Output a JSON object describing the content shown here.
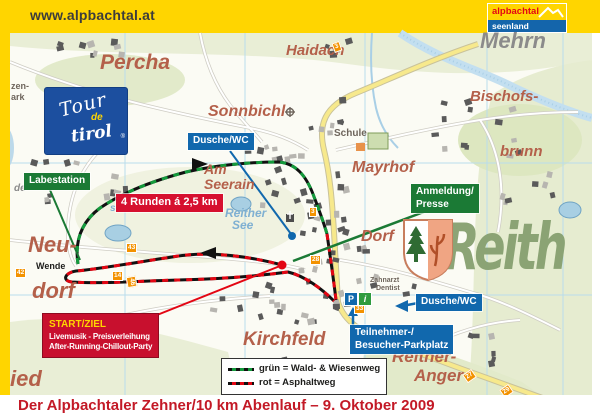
{
  "banner": {
    "url": "www.alpbachtal.at",
    "logo_line1": "alpbachtal",
    "logo_line2": "seenland"
  },
  "caption": "Der Alpbachtaler Zehner/10 km Abenlauf – 9. Oktober 2009",
  "tour_logo": {
    "line1": "Tour",
    "line2": "de",
    "line3": "tirol",
    "reg": "®"
  },
  "reith_watermark": "Reith",
  "info_boxes": {
    "labestation": "Labestation",
    "runden": "4 Runden á 2,5 km",
    "dusche1": "Dusche/WC",
    "dusche2": "Dusche/WC",
    "anmeldung_line1": "Anmeldung/",
    "anmeldung_line2": "Presse",
    "teilnehmer_line1": "Teilnehmer-/",
    "teilnehmer_line2": "Besucher-Parkplatz"
  },
  "start_box": {
    "title": "START/ZIEL",
    "line1": "Livemusik - Preisverleihung",
    "line2": "After-Running-Chillout-Party"
  },
  "legend": {
    "line1": "grün = Wald- & Wiesenweg",
    "line2": "rot = Asphaltweg"
  },
  "icons": {
    "parking": "P",
    "info": "i"
  },
  "places": [
    {
      "t": "Percha",
      "x": 100,
      "y": 52,
      "fs": 21
    },
    {
      "t": "Haidach",
      "x": 286,
      "y": 43,
      "fs": 15
    },
    {
      "t": "Mehrn",
      "x": 480,
      "y": 30,
      "fs": 22,
      "c": "grey"
    },
    {
      "t": "Bischofs-",
      "x": 470,
      "y": 89,
      "fs": 15
    },
    {
      "t": "brunn",
      "x": 500,
      "y": 144,
      "fs": 15
    },
    {
      "t": "Sonnbichl",
      "x": 208,
      "y": 104,
      "fs": 16
    },
    {
      "t": "Am",
      "x": 204,
      "y": 162,
      "fs": 14
    },
    {
      "t": "Seerain",
      "x": 204,
      "y": 177,
      "fs": 14
    },
    {
      "t": "Mayrhof",
      "x": 352,
      "y": 160,
      "fs": 16
    },
    {
      "t": "Dorf",
      "x": 361,
      "y": 229,
      "fs": 16
    },
    {
      "t": "Neu-",
      "x": 28,
      "y": 234,
      "fs": 22
    },
    {
      "t": "dorf",
      "x": 32,
      "y": 280,
      "fs": 22
    },
    {
      "t": "ied",
      "x": 10,
      "y": 368,
      "fs": 22
    },
    {
      "t": "Kirchfeld",
      "x": 243,
      "y": 330,
      "fs": 19
    },
    {
      "t": "Reither-",
      "x": 392,
      "y": 348,
      "fs": 17
    },
    {
      "t": "Anger",
      "x": 414,
      "y": 367,
      "fs": 17
    },
    {
      "t": "Reither",
      "x": 225,
      "y": 207,
      "fs": 12,
      "c": "water"
    },
    {
      "t": "See",
      "x": 232,
      "y": 219,
      "fs": 12,
      "c": "water"
    },
    {
      "t": "see",
      "x": 110,
      "y": 204,
      "fs": 10,
      "c": "water"
    },
    {
      "t": "Schule",
      "x": 334,
      "y": 129,
      "fs": 10,
      "c": "small"
    },
    {
      "t": "Wende",
      "x": 36,
      "y": 262,
      "fs": 9,
      "c": "dark"
    },
    {
      "t": "Zahnarzt",
      "x": 370,
      "y": 277,
      "fs": 7,
      "c": "small"
    },
    {
      "t": "Dentist",
      "x": 376,
      "y": 285,
      "fs": 7,
      "c": "small"
    },
    {
      "t": "zen-",
      "x": 11,
      "y": 82,
      "fs": 9,
      "c": "small"
    },
    {
      "t": "ark",
      "x": 11,
      "y": 93,
      "fs": 9,
      "c": "small"
    },
    {
      "t": "de",
      "x": 14,
      "y": 184,
      "fs": 10,
      "c": "grey"
    }
  ],
  "orange_markers": [
    {
      "t": "3",
      "x": 333,
      "y": 42,
      "r": -20
    },
    {
      "t": "3",
      "x": 309,
      "y": 207,
      "r": 0
    },
    {
      "t": "28",
      "x": 310,
      "y": 255,
      "r": 0
    },
    {
      "t": "43",
      "x": 126,
      "y": 243,
      "r": 0
    },
    {
      "t": "14",
      "x": 112,
      "y": 271,
      "r": 0
    },
    {
      "t": "46",
      "x": 126,
      "y": 277,
      "r": 80
    },
    {
      "t": "33",
      "x": 354,
      "y": 304,
      "r": 0
    },
    {
      "t": "27",
      "x": 464,
      "y": 371,
      "r": -35
    },
    {
      "t": "29",
      "x": 501,
      "y": 386,
      "r": -35
    },
    {
      "t": "42",
      "x": 15,
      "y": 268,
      "r": 0
    }
  ],
  "colors": {
    "banner_yellow": "#ffd500",
    "box_red": "#d6102f",
    "box_green": "#1b7a35",
    "box_blue": "#1168ad",
    "route_green": "#149a3c",
    "route_red": "#e30613",
    "place_label": "#b4604a",
    "caption_red": "#c31926"
  }
}
